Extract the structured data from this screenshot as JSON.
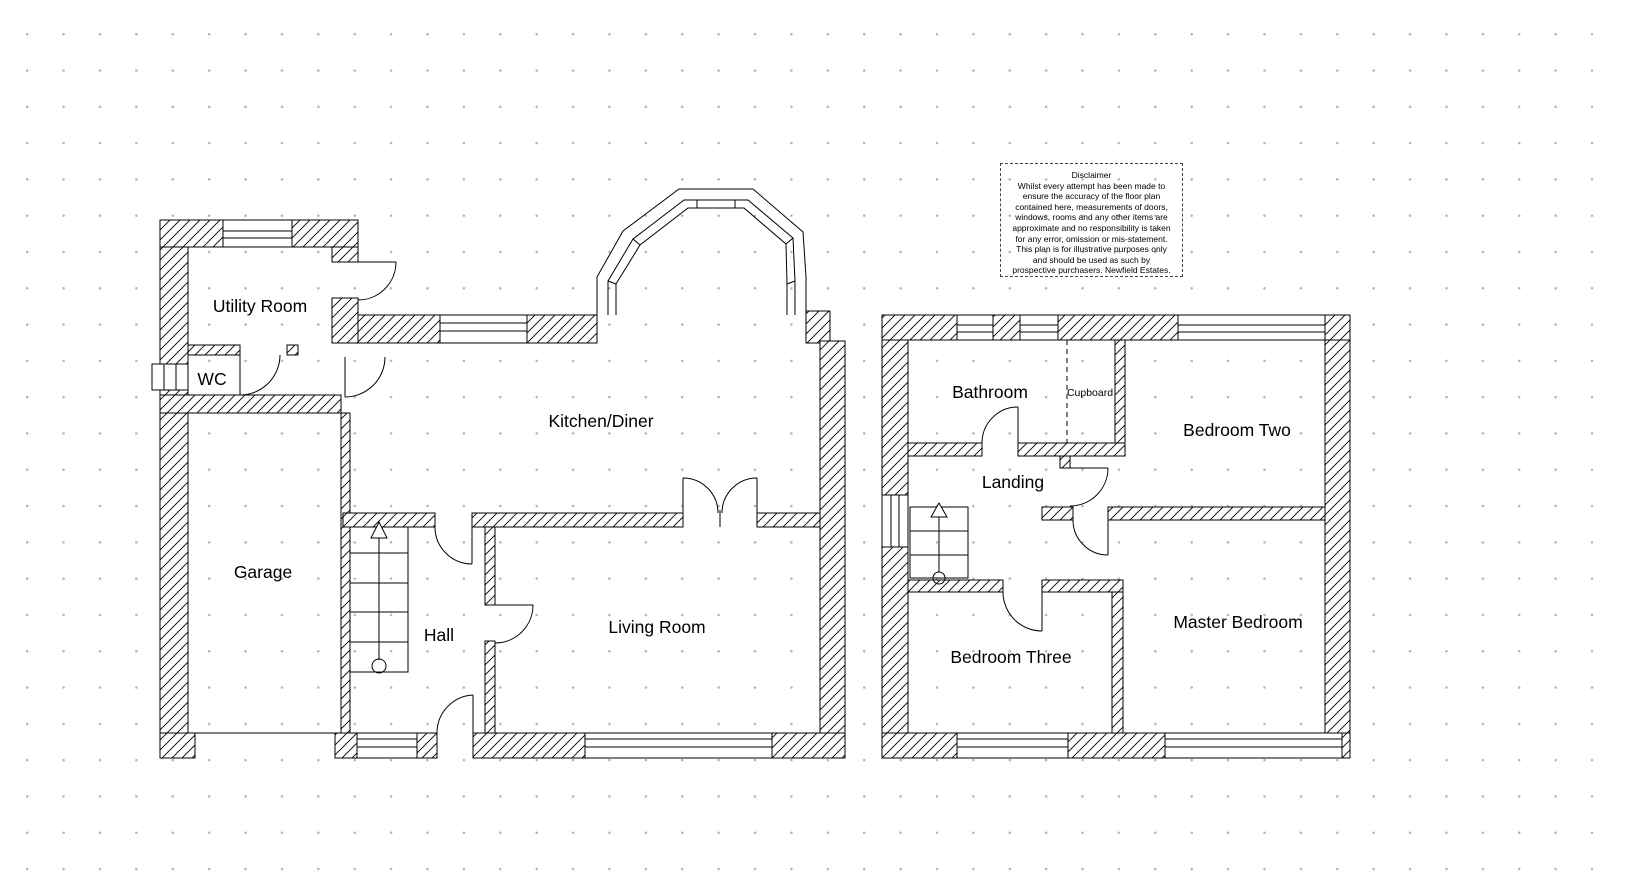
{
  "colors": {
    "background": "#ffffff",
    "line": "#000000",
    "grid_dots": "#b3b3b3"
  },
  "ground_floor": {
    "rooms": {
      "utility": "Utility Room",
      "wc": "WC",
      "garage": "Garage",
      "kitchen": "Kitchen/Diner",
      "hall": "Hall",
      "living": "Living Room"
    }
  },
  "first_floor": {
    "rooms": {
      "bathroom": "Bathroom",
      "cupboard": "Cupboard",
      "bedroom_two": "Bedroom Two",
      "landing": "Landing",
      "bedroom_three": "Bedroom Three",
      "master": "Master Bedroom"
    }
  },
  "disclaimer": {
    "title": "Disclaimer",
    "lines": [
      "Whilst every attempt has been made to",
      "ensure the accuracy of the floor plan",
      "contained here, measurements of doors,",
      "windows, rooms and any other items are",
      "approximate and no responsibility is taken",
      "for any error, omission or mis-statement.",
      "This plan is for illustrative purposes only",
      "and should be used as such by",
      "prospective purchasers. Newfield Estates."
    ]
  }
}
